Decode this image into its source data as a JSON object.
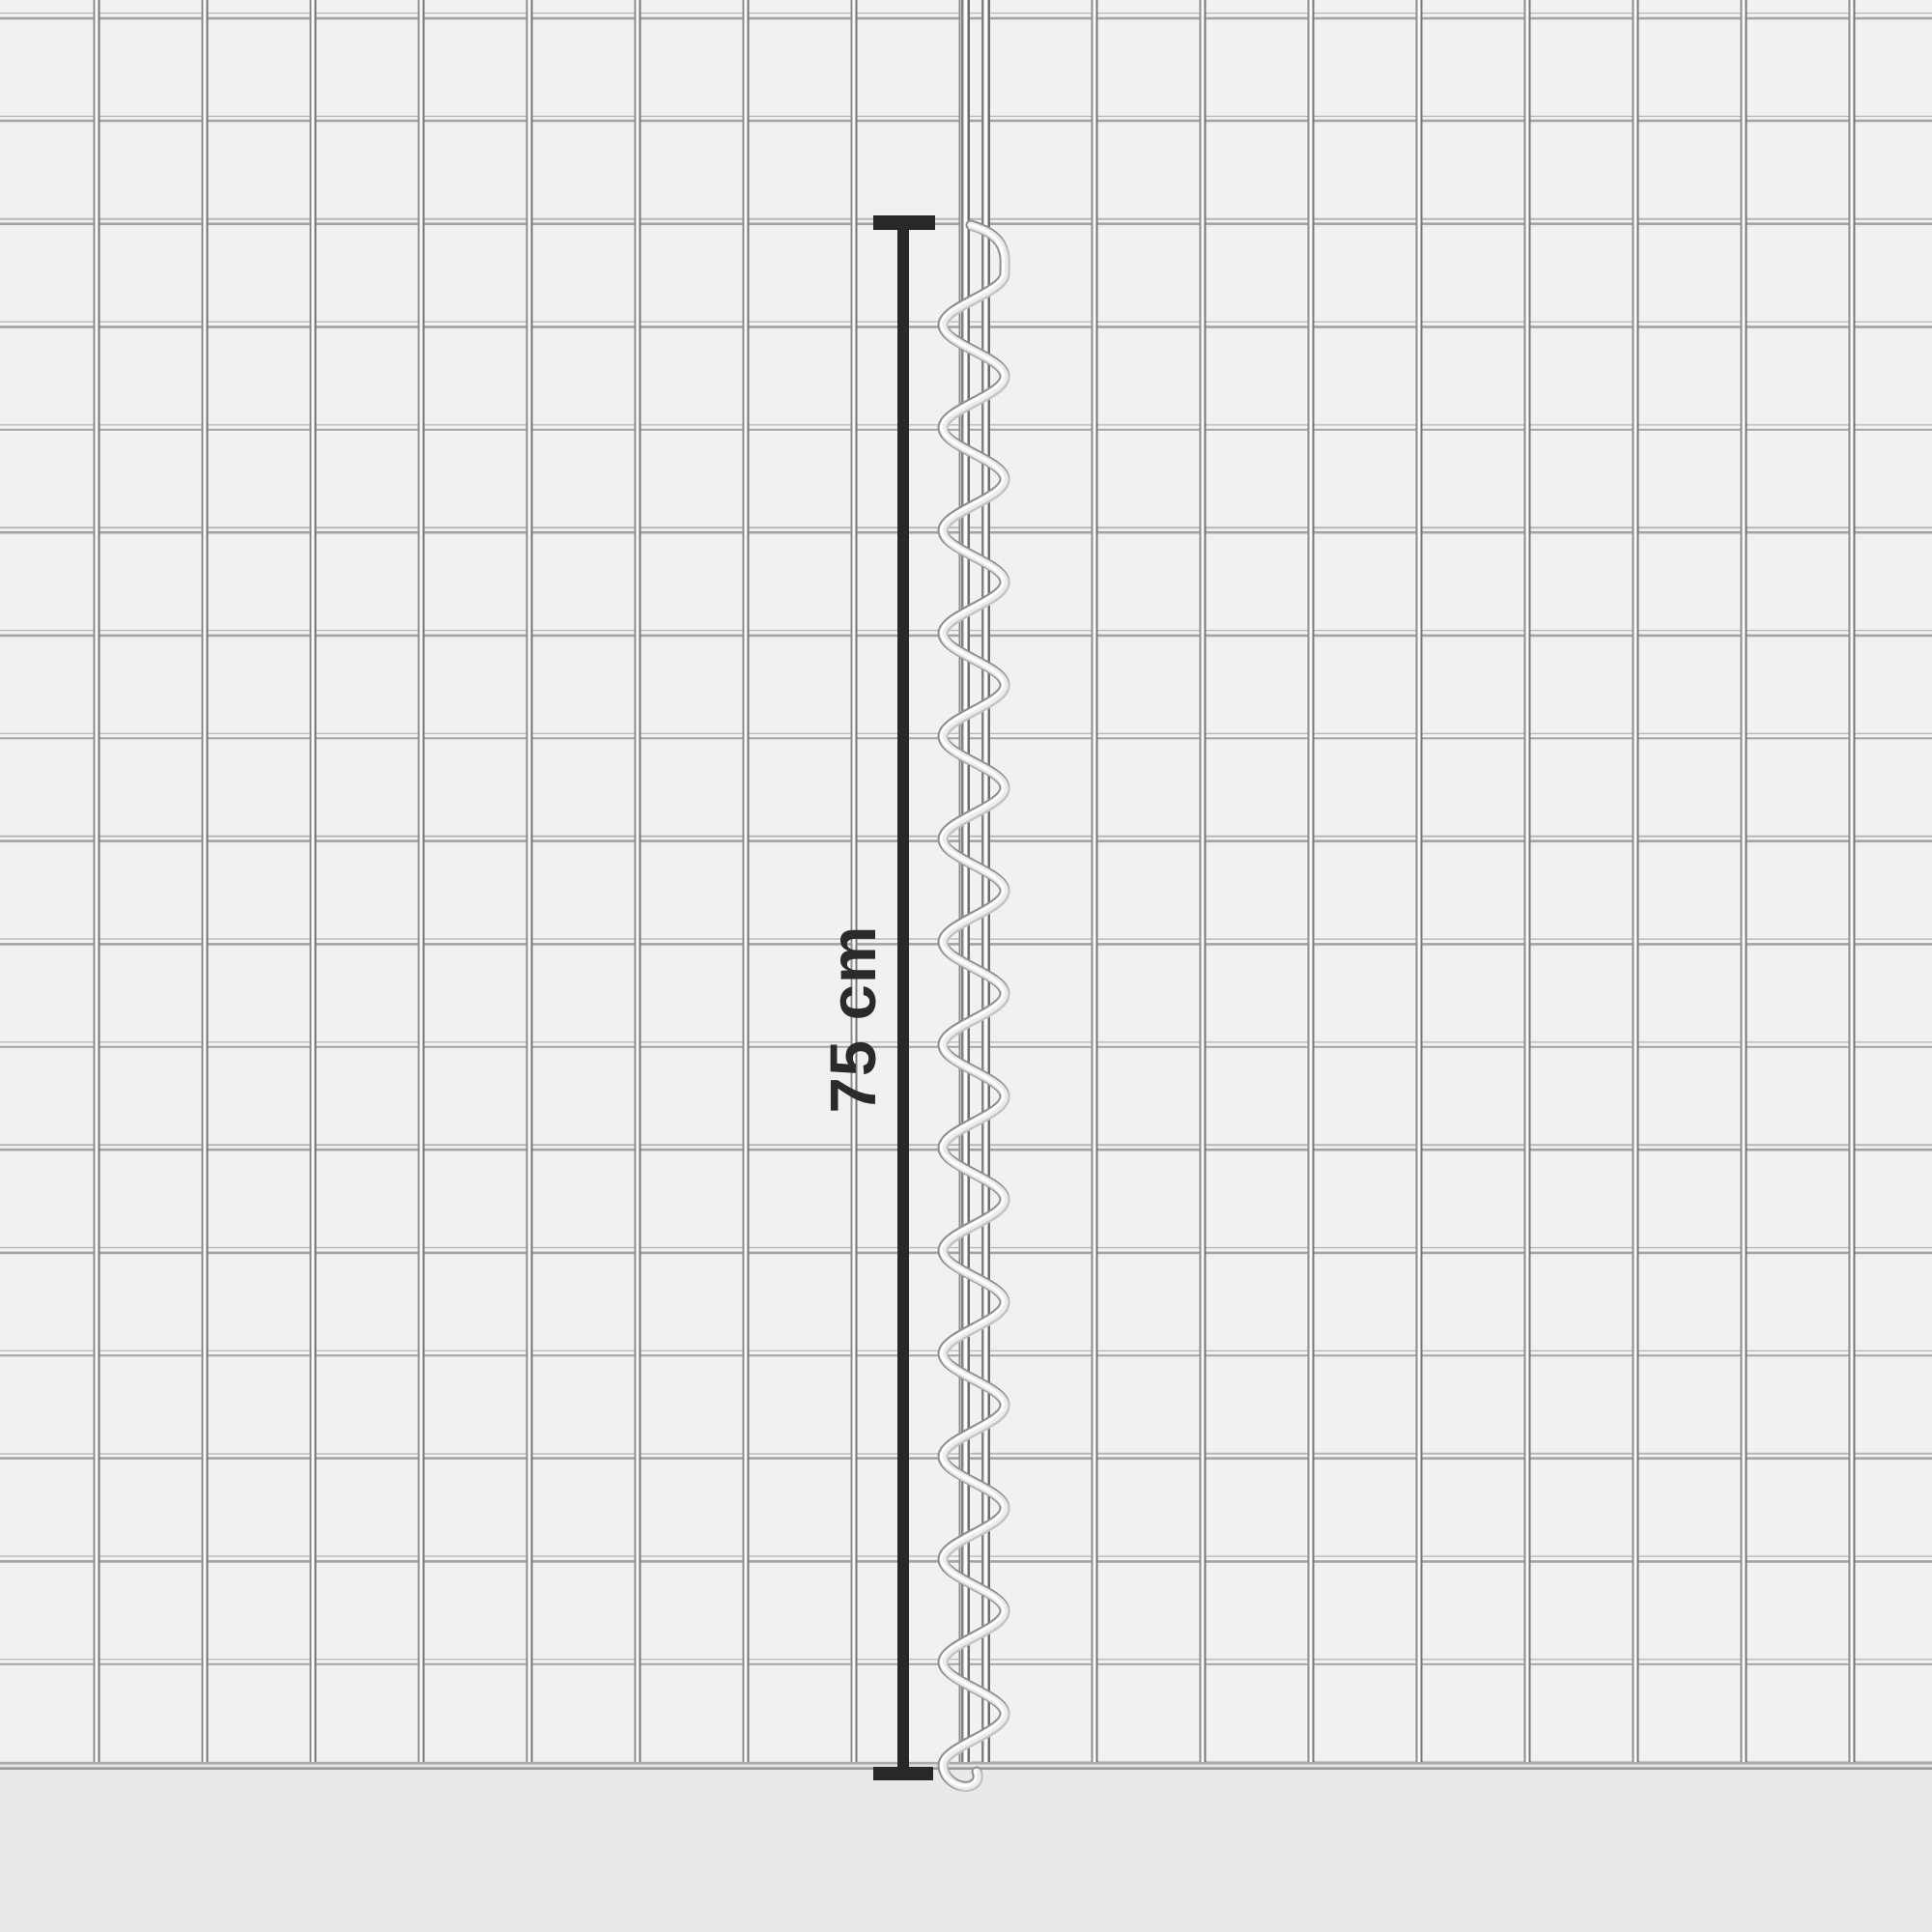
{
  "annotation": {
    "label": "75 cm",
    "orientation": "vertical",
    "line_color": "#282828",
    "text_color": "#2a2a2a"
  },
  "scene": {
    "description": "Two galvanized welded wire-mesh panels joined edge to edge by a vertical spiral connector wire; a black dimension line marks the spiral length",
    "background_color": "#e9e9e9",
    "panel_color": "#f1f1f1",
    "wire_color": "#b6b6b6",
    "spiral_color": "#d9d9d9"
  }
}
